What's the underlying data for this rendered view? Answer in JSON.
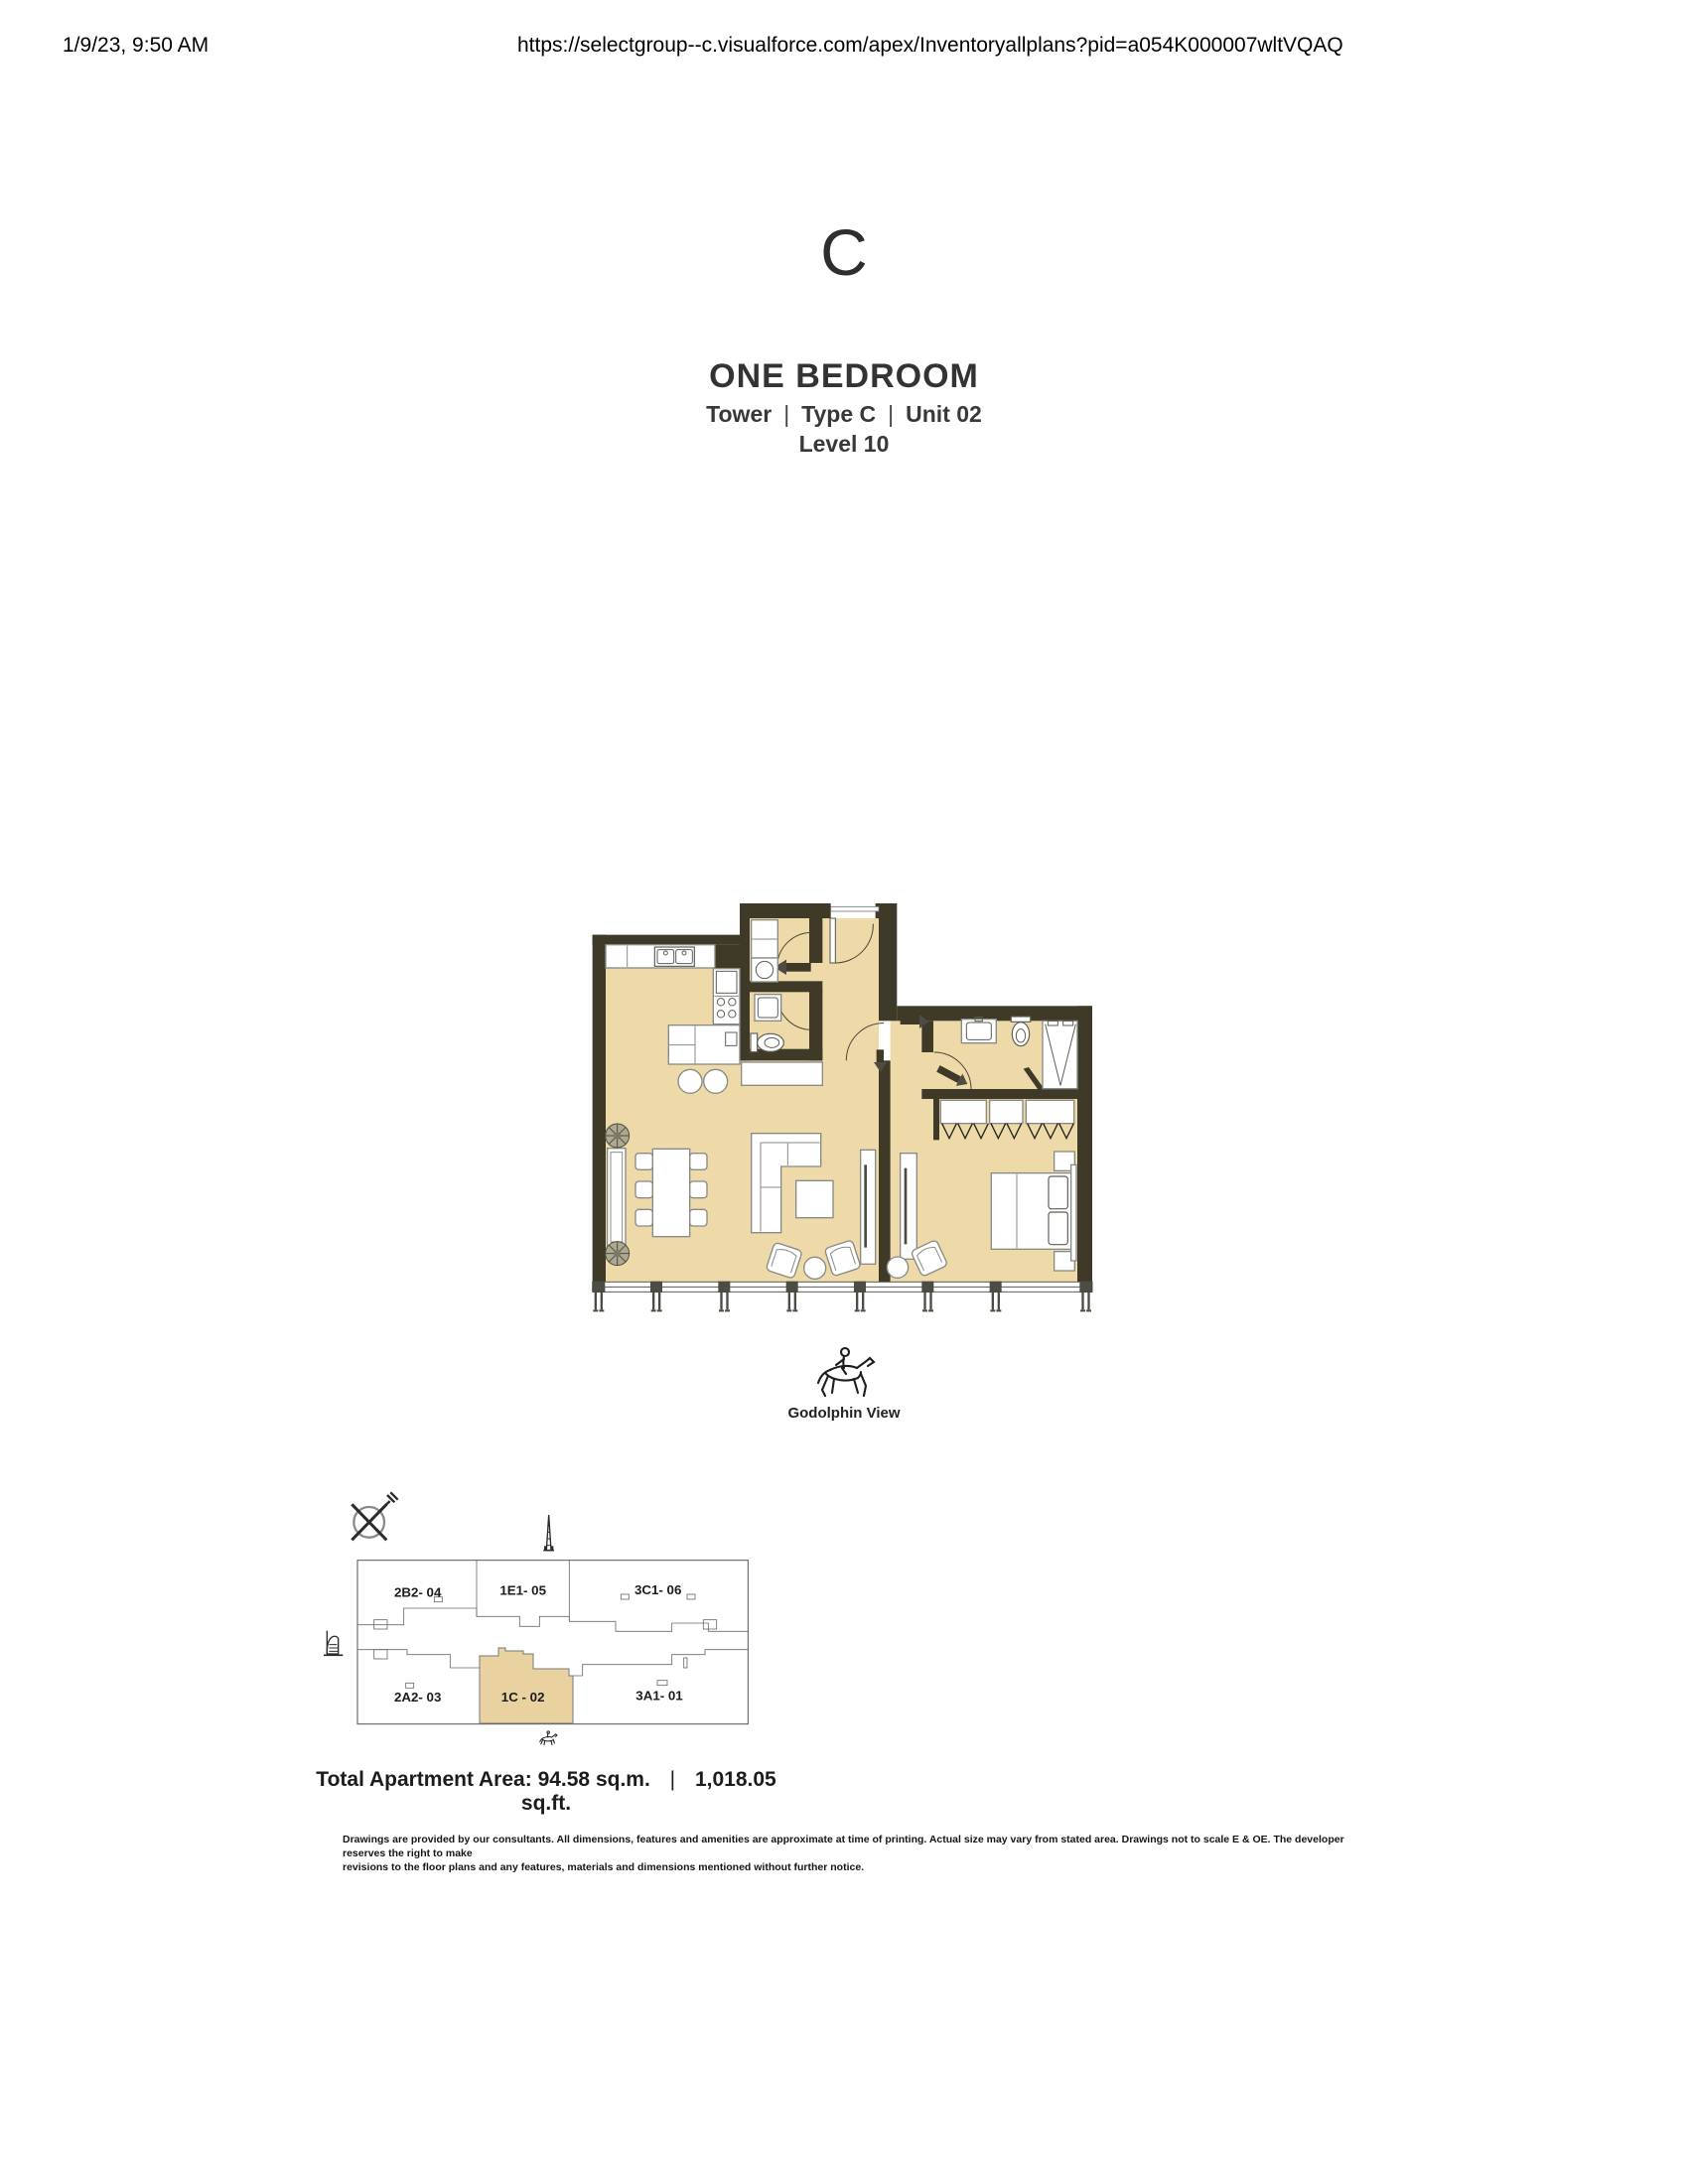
{
  "print_header": {
    "timestamp": "1/9/23, 9:50 AM",
    "url": "https://selectgroup--c.visualforce.com/apex/Inventoryallplans?pid=a054K000007wltVQAQ"
  },
  "unit_card": {
    "type_letter": "C",
    "title": "ONE BEDROOM",
    "subtitle": {
      "part1": "Tower",
      "separator": "|",
      "part2": "Type C",
      "part3": "Unit 02"
    },
    "level": "Level 10"
  },
  "floor_plan": {
    "view_label": "Godolphin View"
  },
  "key_plan": {
    "units": [
      {
        "label": "2B2- 04",
        "highlighted": false
      },
      {
        "label": "1E1- 05",
        "highlighted": false
      },
      {
        "label": "3C1- 06",
        "highlighted": false
      },
      {
        "label": "2A2- 03",
        "highlighted": false
      },
      {
        "label": "1C - 02",
        "highlighted": true
      },
      {
        "label": "3A1- 01",
        "highlighted": false
      }
    ]
  },
  "area_summary": {
    "label": "Total Apartment Area:",
    "sqm": "94.58 sq.m.",
    "separator": "|",
    "sqft": "1,018.05 sq.ft."
  },
  "disclaimer": {
    "line1": "Drawings are provided by our consultants. All dimensions, features and amenities are approximate at time of printing.  Actual size may vary from stated area. Drawings not to scale E & OE. The developer reserves the right to make",
    "line2": "revisions to the floor plans and any features, materials and dimensions mentioned without further notice."
  },
  "colors": {
    "floor_beige": "#eed9a8",
    "wall_olive": "#3e3a27",
    "key_plan_highlight": "#ead1a0"
  }
}
